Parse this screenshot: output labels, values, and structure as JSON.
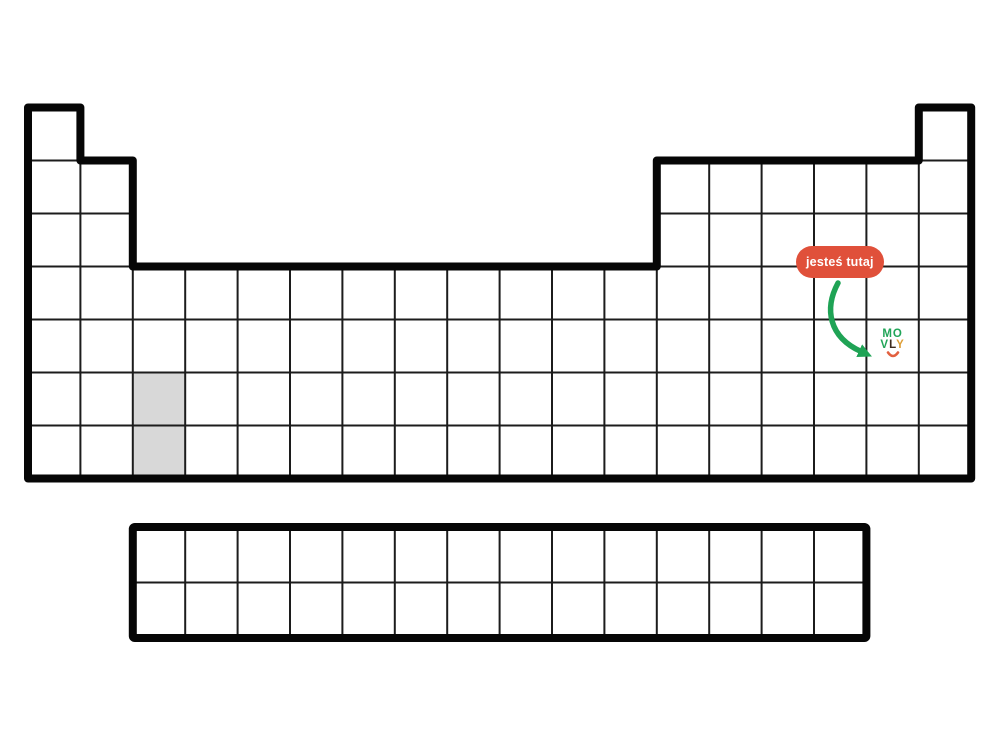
{
  "page": {
    "background": "#ffffff"
  },
  "periodic_table": {
    "outline_color": "#060606",
    "grid_line_color": "#1c1c1c",
    "cell_fill": "#ffffff",
    "highlight_fill": "#d8d8d8",
    "main_block": {
      "columns": 18,
      "rows": 7,
      "row_layout": [
        {
          "row": 1,
          "col_spans": [
            [
              1,
              1
            ],
            [
              18,
              18
            ]
          ]
        },
        {
          "row": 2,
          "col_spans": [
            [
              1,
              2
            ],
            [
              13,
              18
            ]
          ]
        },
        {
          "row": 3,
          "col_spans": [
            [
              1,
              2
            ],
            [
              13,
              18
            ]
          ]
        },
        {
          "row": 4,
          "col_spans": [
            [
              1,
              18
            ]
          ]
        },
        {
          "row": 5,
          "col_spans": [
            [
              1,
              18
            ]
          ]
        },
        {
          "row": 6,
          "col_spans": [
            [
              1,
              18
            ]
          ]
        },
        {
          "row": 7,
          "col_spans": [
            [
              1,
              18
            ]
          ]
        }
      ],
      "highlighted_cells": [
        {
          "row": 6,
          "col": 3
        },
        {
          "row": 7,
          "col": 3
        }
      ],
      "marker_cell": {
        "row": 5,
        "col": 17
      }
    },
    "f_block": {
      "columns": 14,
      "rows": 2
    }
  },
  "annotation": {
    "badge_label": "jesteś tutaj",
    "badge_bg": "#E0503A",
    "badge_text_color": "#ffffff",
    "arrow_color": "#1FA355"
  },
  "logo": {
    "line1": [
      {
        "char": "M",
        "color": "#21A558"
      },
      {
        "char": "O",
        "color": "#21A558"
      }
    ],
    "line2": [
      {
        "char": "V",
        "color": "#21A558"
      },
      {
        "char": "L",
        "color": "#3E2C20"
      },
      {
        "char": "Y",
        "color": "#DE9E35"
      }
    ],
    "smile_color": "#E2603F"
  }
}
